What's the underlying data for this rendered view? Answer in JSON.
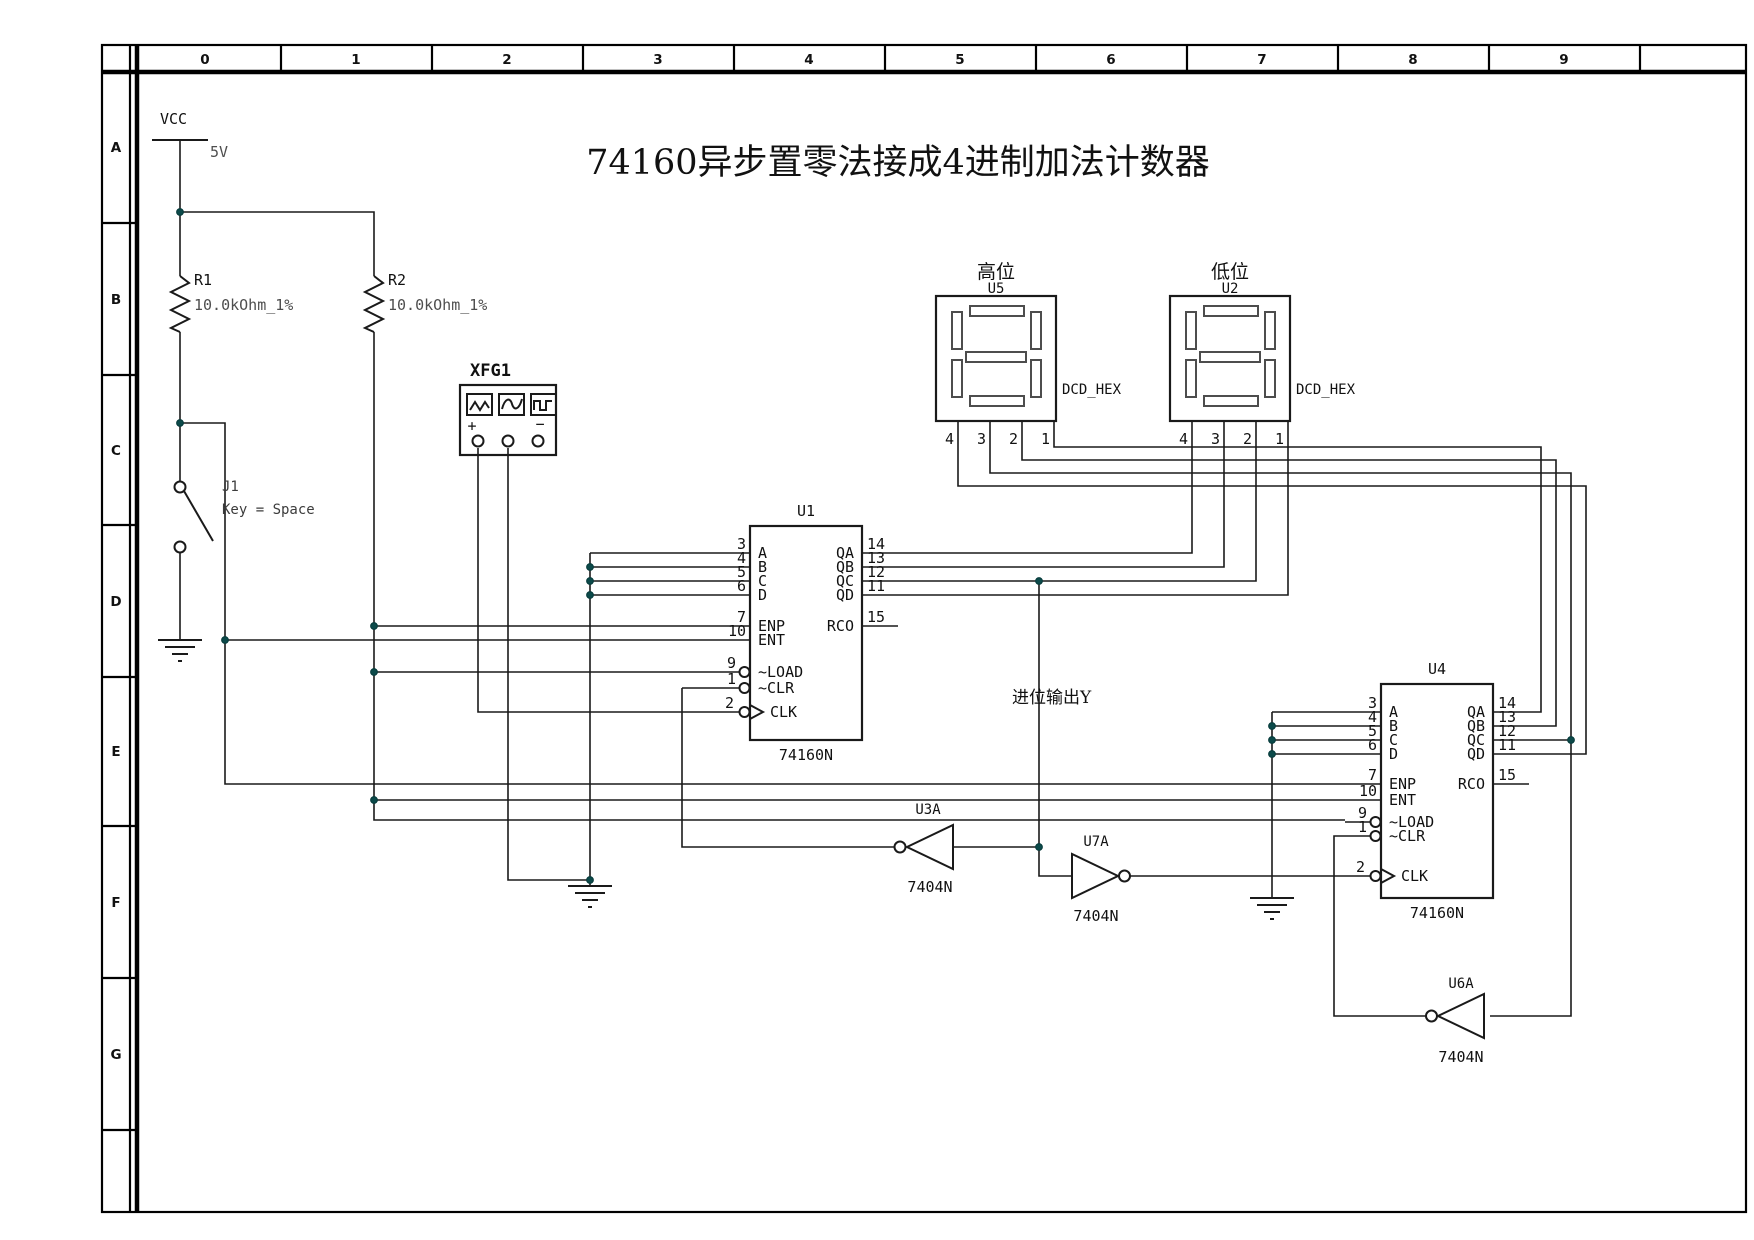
{
  "title": "74160异步置零法接成4进制加法计数器",
  "frame": {
    "cols": [
      "0",
      "1",
      "2",
      "3",
      "4",
      "5",
      "6",
      "7",
      "8",
      "9"
    ],
    "rows": [
      "A",
      "B",
      "C",
      "D",
      "E",
      "F",
      "G"
    ]
  },
  "power": {
    "vcc": "VCC",
    "vcc_value": "5V"
  },
  "r1": {
    "ref": "R1",
    "value": "10.0kOhm_1%"
  },
  "r2": {
    "ref": "R2",
    "value": "10.0kOhm_1%"
  },
  "j1": {
    "ref": "J1",
    "key": "Key = Space"
  },
  "xfg1": {
    "ref": "XFG1",
    "plus": "+",
    "minus": "−"
  },
  "u1": {
    "ref": "U1",
    "part": "74160N",
    "left": [
      {
        "n": "3",
        "l": "A"
      },
      {
        "n": "4",
        "l": "B"
      },
      {
        "n": "5",
        "l": "C"
      },
      {
        "n": "6",
        "l": "D"
      },
      {
        "n": "7",
        "l": "ENP"
      },
      {
        "n": "10",
        "l": "ENT"
      },
      {
        "n": "9",
        "l": "~LOAD"
      },
      {
        "n": "1",
        "l": "~CLR"
      },
      {
        "n": "2",
        "l": "CLK"
      }
    ],
    "right": [
      {
        "n": "14",
        "l": "QA"
      },
      {
        "n": "13",
        "l": "QB"
      },
      {
        "n": "12",
        "l": "QC"
      },
      {
        "n": "11",
        "l": "QD"
      },
      {
        "n": "15",
        "l": "RCO"
      }
    ]
  },
  "u4": {
    "ref": "U4",
    "part": "74160N",
    "left": [
      {
        "n": "3",
        "l": "A"
      },
      {
        "n": "4",
        "l": "B"
      },
      {
        "n": "5",
        "l": "C"
      },
      {
        "n": "6",
        "l": "D"
      },
      {
        "n": "7",
        "l": "ENP"
      },
      {
        "n": "10",
        "l": "ENT"
      },
      {
        "n": "9",
        "l": "~LOAD"
      },
      {
        "n": "1",
        "l": "~CLR"
      },
      {
        "n": "2",
        "l": "CLK"
      }
    ],
    "right": [
      {
        "n": "14",
        "l": "QA"
      },
      {
        "n": "13",
        "l": "QB"
      },
      {
        "n": "12",
        "l": "QC"
      },
      {
        "n": "11",
        "l": "QD"
      },
      {
        "n": "15",
        "l": "RCO"
      }
    ]
  },
  "u5": {
    "ref": "U5",
    "part": "DCD_HEX",
    "heading": "高位",
    "pins": [
      "4",
      "3",
      "2",
      "1"
    ]
  },
  "u2": {
    "ref": "U2",
    "part": "DCD_HEX",
    "heading": "低位",
    "pins": [
      "4",
      "3",
      "2",
      "1"
    ]
  },
  "u3a": {
    "ref": "U3A",
    "part": "7404N"
  },
  "u7a": {
    "ref": "U7A",
    "part": "7404N"
  },
  "u6a": {
    "ref": "U6A",
    "part": "7404N"
  },
  "carry_label": "进位输出Y"
}
